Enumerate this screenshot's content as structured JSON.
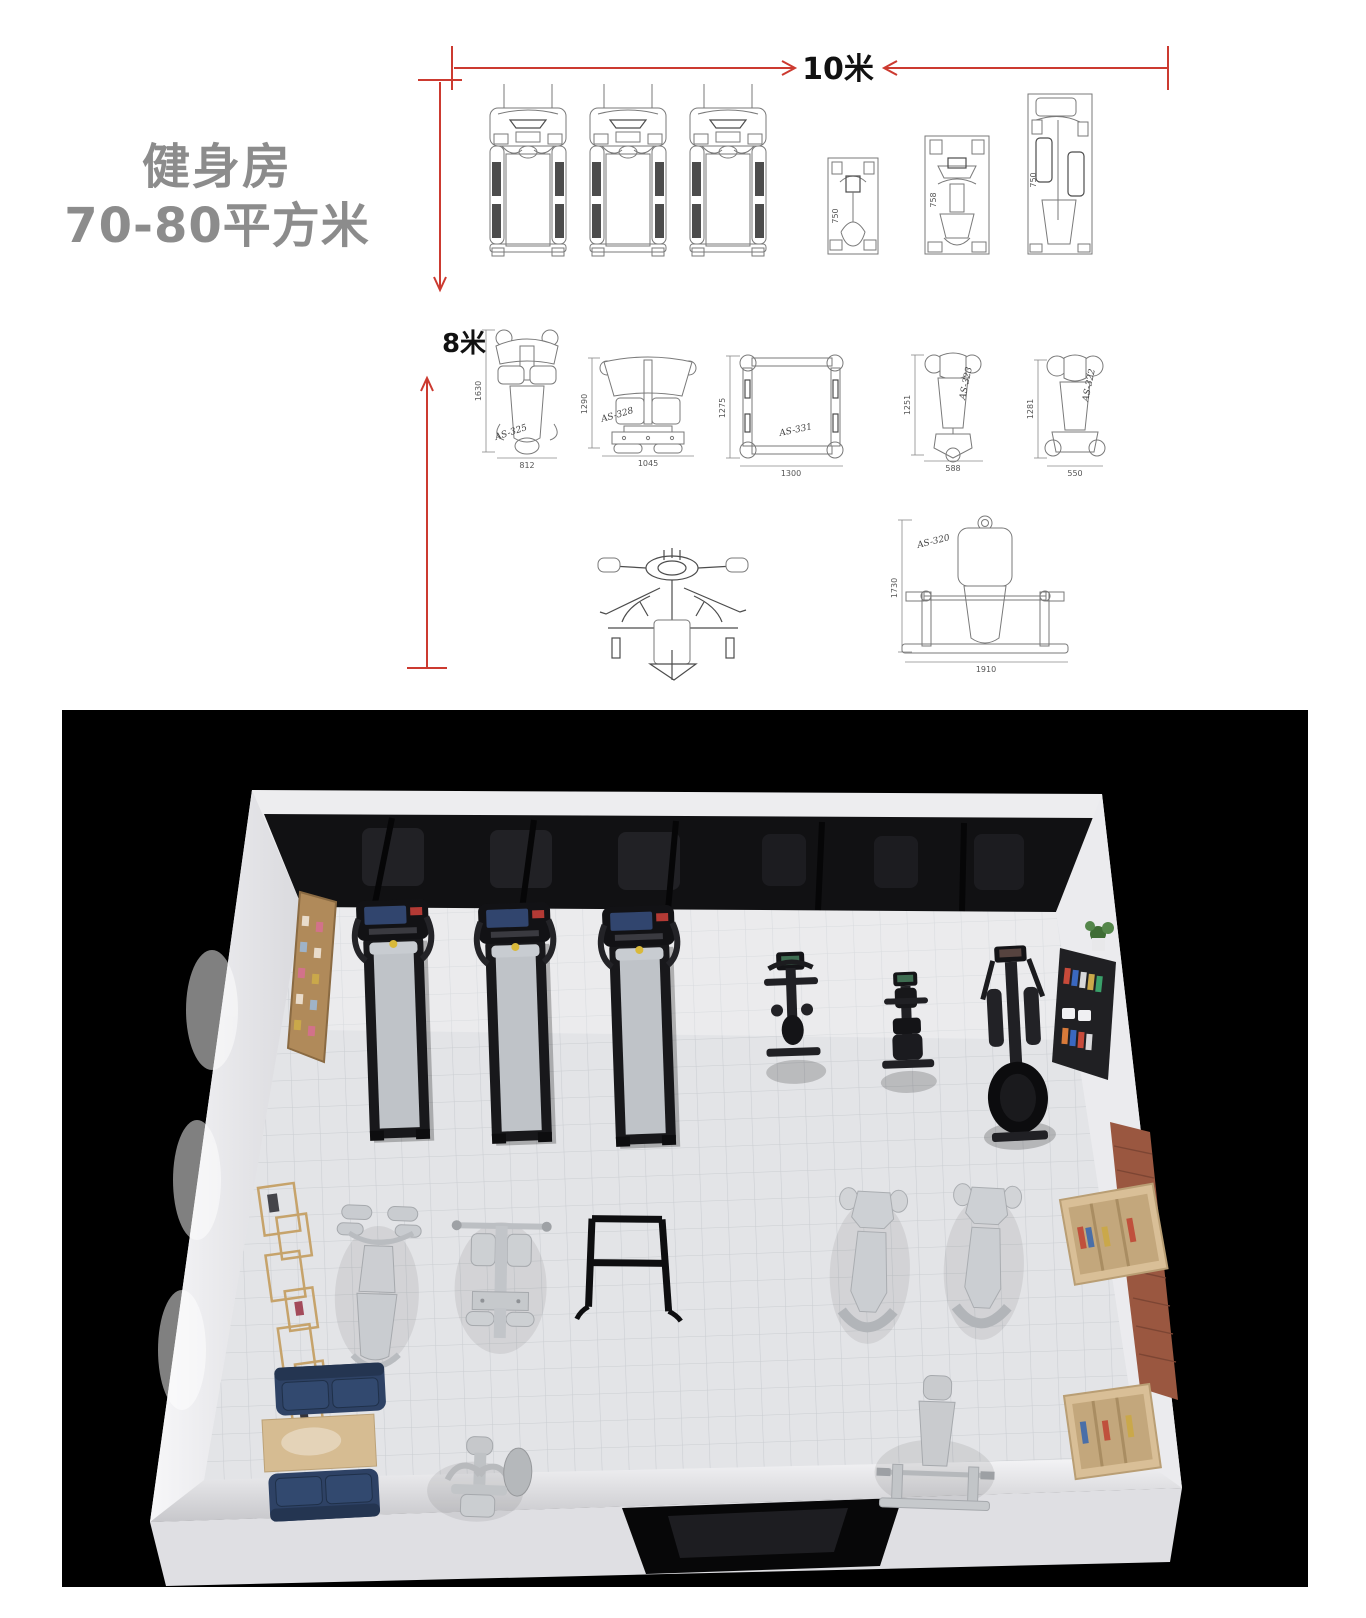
{
  "plan": {
    "title_line1": "健身房",
    "title_line2": "70-80平方米",
    "width_label": "10米",
    "height_label": "8米",
    "top_row_labels": [
      "750",
      "758",
      "750"
    ],
    "machines": {
      "as325": {
        "label": "AS-325",
        "height": "1630",
        "width": "812"
      },
      "as328": {
        "label": "AS-328",
        "height": "1290",
        "width": "1045"
      },
      "as331": {
        "label": "AS-331",
        "height": "1275",
        "width": "1300"
      },
      "as323": {
        "label": "AS-323",
        "height": "1251",
        "width": "588"
      },
      "as322": {
        "label": "AS-322",
        "height": "1281",
        "width": "550"
      },
      "as320": {
        "label": "AS-320",
        "height": "1730",
        "width": "1910"
      }
    }
  },
  "render": {
    "area_value": "70-80m",
    "area_superscript": "2"
  },
  "colors": {
    "dimension_red": "#cc3a30",
    "title_gray": "#8c8c8c",
    "panel_black": "#000000",
    "sofa_navy": "#2e4265",
    "wood": "#d2b88e",
    "brick": "#9a5740"
  }
}
